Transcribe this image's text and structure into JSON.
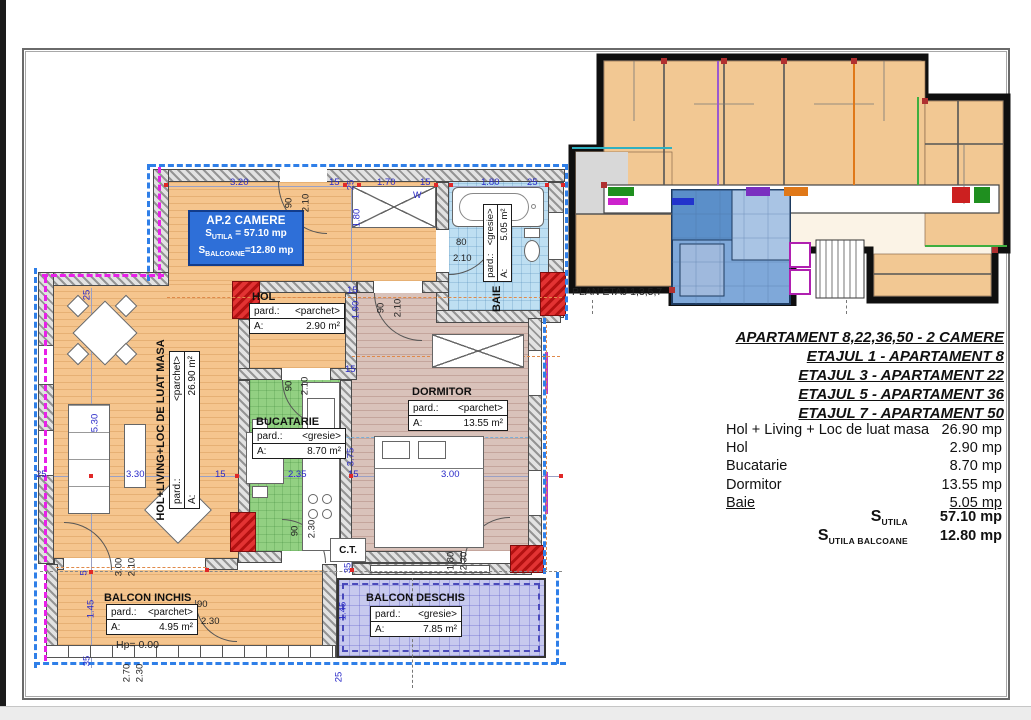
{
  "key_plan": {
    "label": "PLAN ETAJ 1,3,5,7"
  },
  "info_box": {
    "title": "AP.2 CAMERE",
    "s1_prefix": "S",
    "s1_sub": "UTILA",
    "s1_val": " = 57.10 mp",
    "s2_prefix": "S",
    "s2_sub": "BALCOANE",
    "s2_val": "=12.80 mp"
  },
  "rooms": {
    "living": {
      "title": "HOL+LIVING+LOC DE LUAT MASA",
      "pard_key": "pard.:",
      "pard": "<parchet>",
      "a_key": "A:",
      "a": "26.90 m²"
    },
    "hol": {
      "title": "HOL",
      "pard_key": "pard.:",
      "pard": "<parchet>",
      "a_key": "A:",
      "a": "2.90 m²"
    },
    "bucatarie": {
      "title": "BUCATARIE",
      "pard_key": "pard.:",
      "pard": "<gresie>",
      "a_key": "A:",
      "a": "8.70 m²"
    },
    "dormitor": {
      "title": "DORMITOR",
      "pard_key": "pard.:",
      "pard": "<parchet>",
      "a_key": "A:",
      "a": "13.55 m²"
    },
    "baie": {
      "title": "BAIE",
      "pard_key": "pard.:",
      "pard": "<gresie>",
      "a_key": "A:",
      "a": "5.05 m²"
    },
    "balcon_inchis": {
      "title": "BALCON INCHIS",
      "pard_key": "pard.:",
      "pard": "<parchet>",
      "a_key": "A:",
      "a": "4.95 m²",
      "hp": "Hp= 0.00"
    },
    "balcon_deschis": {
      "title": "BALCON DESCHIS",
      "pard_key": "pard.:",
      "pard": "<gresie>",
      "a_key": "A:",
      "a": "7.85 m²"
    },
    "ct_label": "C.T."
  },
  "dims": {
    "top": [
      "3.20",
      "15",
      "25",
      "1.70",
      "15",
      "1.80",
      "25"
    ],
    "w_mark": "W",
    "entry_door": [
      "90",
      "2.10"
    ],
    "hall_width": "1.80",
    "hol_col": [
      "15",
      "1.90",
      "15"
    ],
    "dorm_door": [
      "90",
      "2.10"
    ],
    "baie_door": [
      "80",
      "2.10"
    ],
    "left_col": [
      "25",
      "5.30"
    ],
    "mid_row": [
      "25",
      "3.30",
      "15",
      "2.35",
      "15",
      "3.00"
    ],
    "kitchen_depth": "3.75",
    "kitchen_door": [
      "90",
      "2.10"
    ],
    "kitchen_door2": [
      "90",
      "2.30"
    ],
    "living_balc_door": [
      "3.00",
      "2.10"
    ],
    "left_col2": [
      "5",
      "1.45",
      "35"
    ],
    "balc_in_door": [
      "90",
      "2.30"
    ],
    "bottom_col": [
      "2.70",
      "2.30"
    ],
    "balc_out": [
      "1.45",
      "25"
    ],
    "ct_width": "35",
    "dorm_balc_door": [
      "1.80",
      "2.30"
    ]
  },
  "panel": {
    "headers": [
      "APARTAMENT 8,22,36,50 - 2 CAMERE",
      "ETAJUL 1 - APARTAMENT 8",
      "ETAJUL 3 - APARTAMENT 22",
      "ETAJUL 5 - APARTAMENT 36",
      "ETAJUL 7 - APARTAMENT 50"
    ],
    "rows": [
      {
        "label": "Hol + Living + Loc de luat masa",
        "value": "26.90 mp"
      },
      {
        "label": "Hol",
        "value": "2.90 mp"
      },
      {
        "label": "Bucatarie",
        "value": "8.70 mp"
      },
      {
        "label": "Dormitor",
        "value": "13.55 mp"
      },
      {
        "label": "Baie",
        "value": "5.05 mp"
      }
    ],
    "totals": [
      {
        "prefix": "S",
        "sub": "UTILA",
        "value": "57.10 mp"
      },
      {
        "prefix": "S",
        "sub": "UTILA BALCOANE",
        "value": "12.80 mp"
      }
    ]
  },
  "colors": {
    "dim_blue": "#2a2ac8",
    "envelope_blue": "#2f7fe8",
    "envelope_magenta": "#e820e8",
    "wall_red": "#d42020",
    "info_box_blue": "#2e6fd8",
    "highlight_unit": "#7fa8d9"
  }
}
